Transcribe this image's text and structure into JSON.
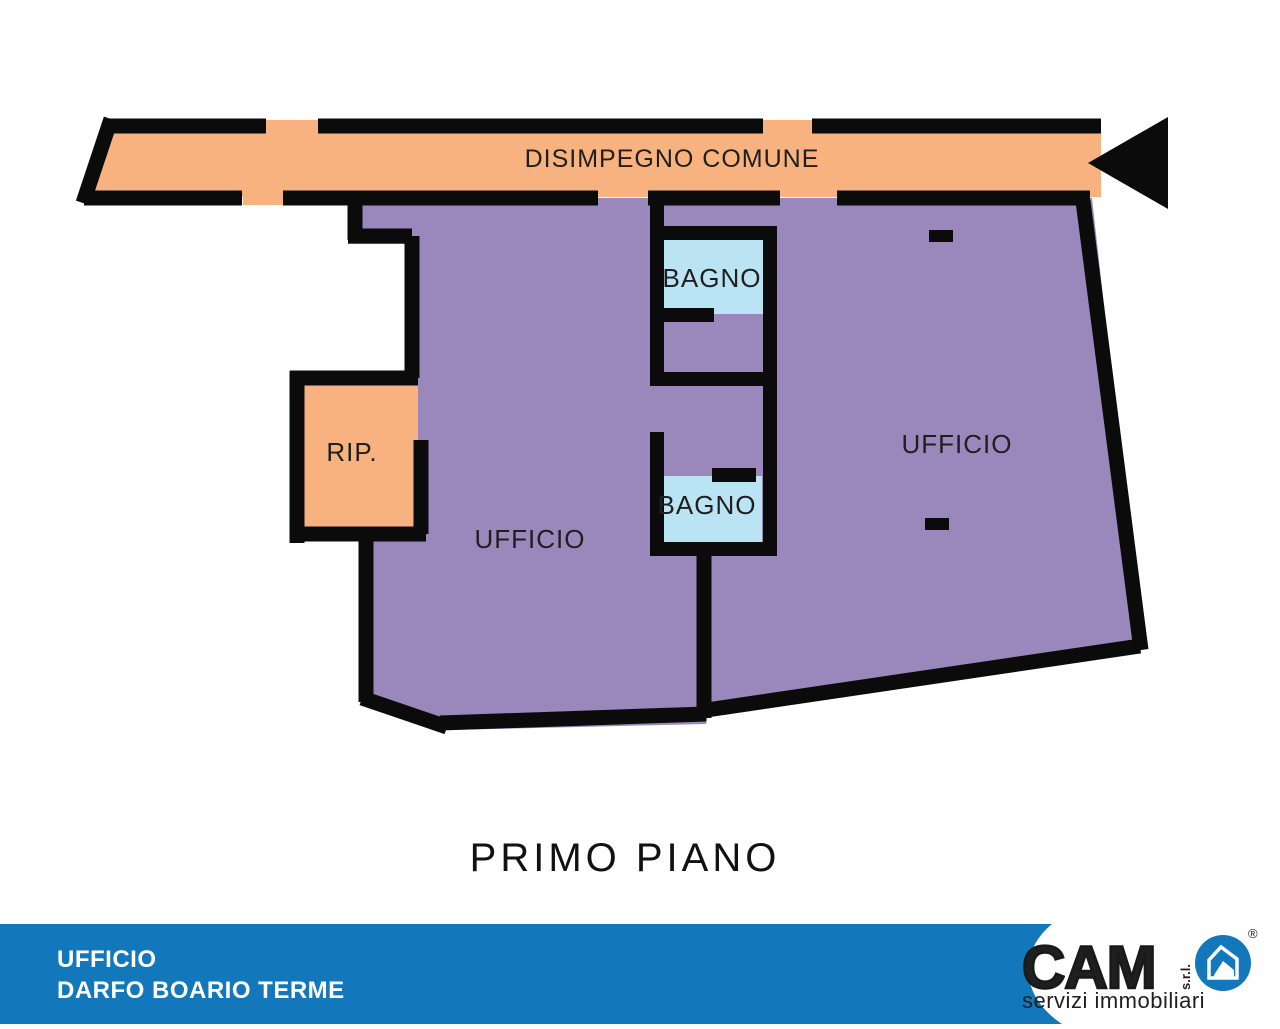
{
  "floor_plan": {
    "corridor": {
      "label": "DISIMPEGNO COMUNE"
    },
    "bathroom_top": {
      "label": "BAGNO"
    },
    "bathroom_bottom": {
      "label": "BAGNO"
    },
    "storage": {
      "label": "RIP."
    },
    "office_left": {
      "label": "UFFICIO"
    },
    "office_right": {
      "label": "UFFICIO"
    },
    "title": "PRIMO PIANO",
    "colors": {
      "corridor_fill": "#F7B280",
      "office_fill": "#9A88BD",
      "bathroom_fill": "#BAE3F3",
      "wall": "#0B0B0B"
    }
  },
  "footer": {
    "property_type": "UFFICIO",
    "location": "DARFO BOARIO TERME",
    "background_color": "#1277BB",
    "logo": {
      "brand": "CAM",
      "suffix": "s.r.l.",
      "tagline": "servizi immobiliari",
      "registered_mark": "®"
    }
  }
}
